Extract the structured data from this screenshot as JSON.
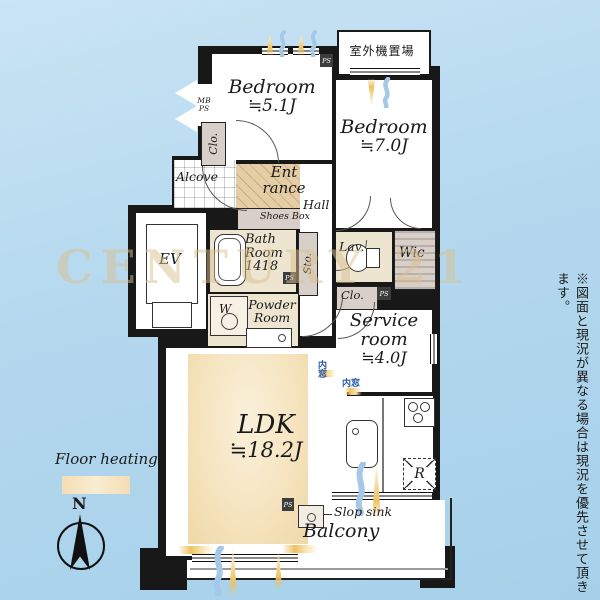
{
  "colors": {
    "background": "#b4d8ee",
    "wall": "#181818",
    "room": "#ffffff",
    "floor_heating": "#f5e3bd",
    "entrance_floor": "#e5cda5",
    "closet_floor": "#d8cfc8",
    "wet_floor": "#ede5d0",
    "sun_accent": "#eec263",
    "breeze_accent": "#a5c8e8",
    "inner_window_text": "#2b5ca6",
    "watermark": "#d9c08f"
  },
  "rooms": {
    "bedroom_small": {
      "name": "Bedroom",
      "size": "≒5.1J"
    },
    "bedroom_large": {
      "name": "Bedroom",
      "size": "≒7.0J"
    },
    "ldk": {
      "name": "LDK",
      "size": "≒18.2J"
    },
    "service": {
      "line1": "Service",
      "line2": "room",
      "size": "≒4.0J"
    },
    "balcony": {
      "name": "Balcony"
    },
    "hall": {
      "name": "Hall"
    },
    "alcove": {
      "name": "Alcove"
    },
    "entrance": {
      "line1": "Ent",
      "line2": "rance"
    },
    "bathroom": {
      "line1": "Bath",
      "line2": "Room",
      "line3": "1418"
    },
    "powder": {
      "line1": "Powder",
      "line2": "Room"
    },
    "lavatory": {
      "name": "Lav."
    },
    "wic": {
      "name": "Wic"
    },
    "elevator": {
      "name": "EV"
    }
  },
  "labels": {
    "shoes_box": "Shoes Box",
    "storage": "Sto.",
    "closet": "Clo.",
    "slop_sink": "Slop sink",
    "outdoor_unit": "室外機置場",
    "refrigerator": "R",
    "washer": "W",
    "meter_box": "MB",
    "pipe_space": "PS",
    "inner_window": "内窓"
  },
  "legend": {
    "floor_heating": "Floor heating",
    "compass_north": "N"
  },
  "note_vertical": "※図面と現況が異なる場合は現況を優先させて頂きます。",
  "watermark": "CENTURY 21"
}
